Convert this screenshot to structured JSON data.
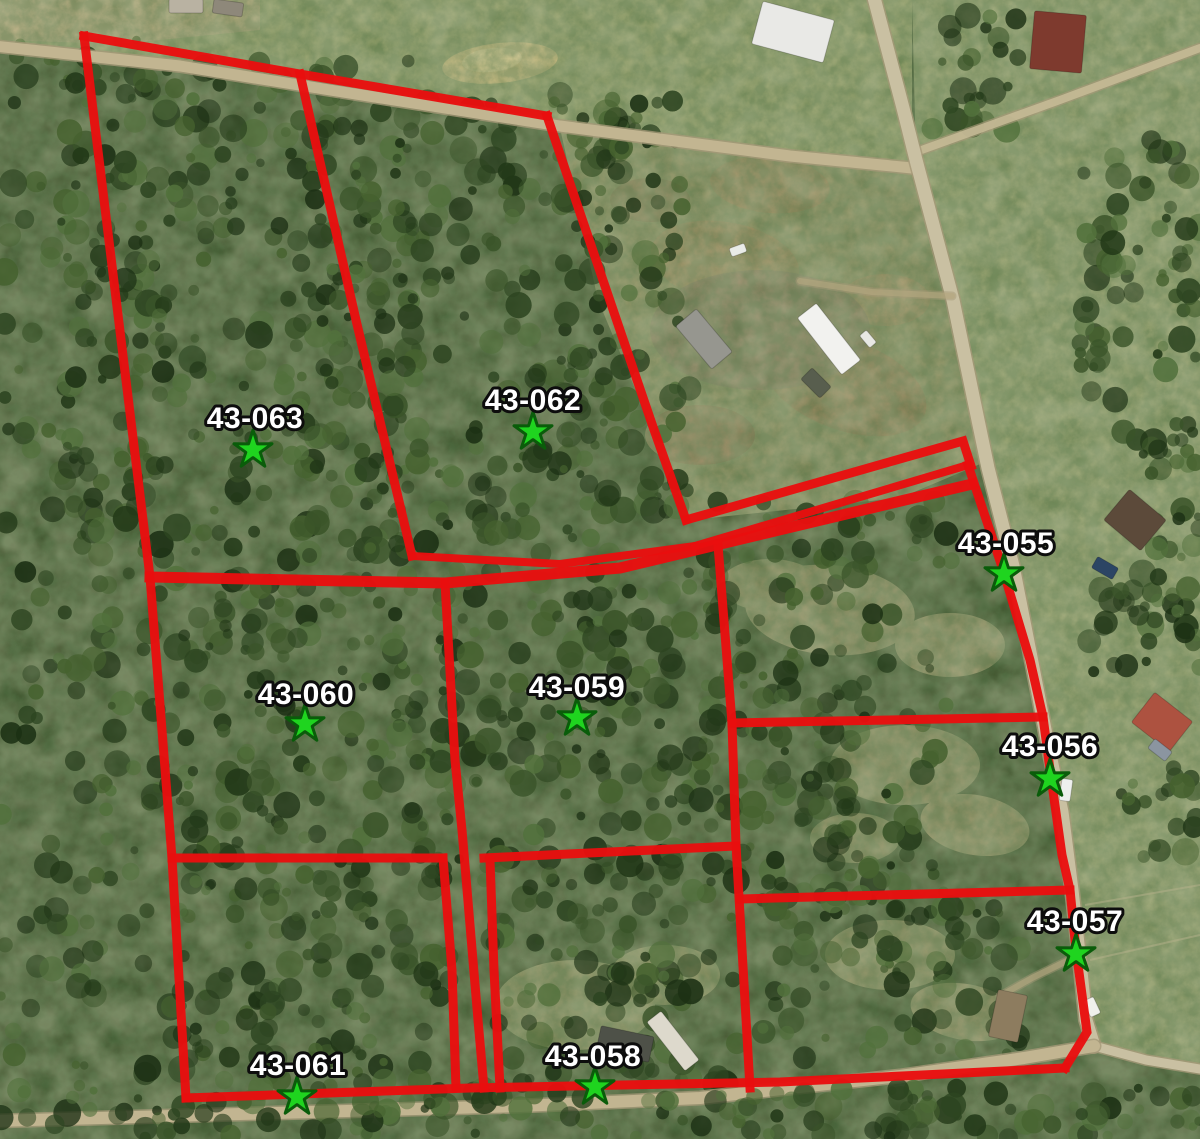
{
  "map": {
    "width": 1200,
    "height": 1139,
    "colors": {
      "boundary": "#e90f0f",
      "star_fill": "#1fd41f",
      "star_stroke": "#0a5c0a",
      "label_fill": "#ffffff",
      "label_stroke": "#0d0d0d",
      "forest_base": "#42552f",
      "field": "#97a16c",
      "road": "#c9c0a2",
      "dirt_road": "#c2b591"
    },
    "markers": [
      {
        "id": "43-063",
        "label_x": 255,
        "label_y": 428,
        "star_x": 253,
        "star_y": 450
      },
      {
        "id": "43-062",
        "label_x": 533,
        "label_y": 410,
        "star_x": 533,
        "star_y": 432
      },
      {
        "id": "43-055",
        "label_x": 1006,
        "label_y": 553,
        "star_x": 1004,
        "star_y": 574
      },
      {
        "id": "43-060",
        "label_x": 306,
        "label_y": 704,
        "star_x": 305,
        "star_y": 724
      },
      {
        "id": "43-059",
        "label_x": 577,
        "label_y": 697,
        "star_x": 577,
        "star_y": 718
      },
      {
        "id": "43-056",
        "label_x": 1050,
        "label_y": 756,
        "star_x": 1050,
        "star_y": 779
      },
      {
        "id": "43-057",
        "label_x": 1075,
        "label_y": 931,
        "star_x": 1076,
        "star_y": 954
      },
      {
        "id": "43-061",
        "label_x": 298,
        "label_y": 1075,
        "star_x": 297,
        "star_y": 1097
      },
      {
        "id": "43-058",
        "label_x": 593,
        "label_y": 1066,
        "star_x": 595,
        "star_y": 1087
      }
    ],
    "boundary_lines": [
      {
        "points": [
          [
            84,
            36
          ],
          [
            150,
            577
          ],
          [
            172,
            858
          ],
          [
            186,
            1098
          ]
        ],
        "w": 9
      },
      {
        "points": [
          [
            84,
            36
          ],
          [
            300,
            74
          ],
          [
            547,
            116
          ]
        ],
        "w": 9
      },
      {
        "points": [
          [
            300,
            74
          ],
          [
            356,
            320
          ],
          [
            412,
            556
          ]
        ],
        "w": 9
      },
      {
        "points": [
          [
            547,
            116
          ],
          [
            652,
            424
          ],
          [
            686,
            520
          ]
        ],
        "w": 9
      },
      {
        "points": [
          [
            412,
            556
          ],
          [
            560,
            564
          ],
          [
            695,
            546
          ]
        ],
        "w": 8
      },
      {
        "points": [
          [
            686,
            520
          ],
          [
            963,
            441
          ],
          [
            971,
            466
          ]
        ],
        "w": 9
      },
      {
        "points": [
          [
            695,
            546
          ],
          [
            968,
            465
          ]
        ],
        "w": 8
      },
      {
        "points": [
          [
            150,
            577
          ],
          [
            445,
            583
          ],
          [
            620,
            568
          ],
          [
            972,
            484
          ]
        ],
        "w": 11
      },
      {
        "points": [
          [
            968,
            465
          ],
          [
            1003,
            570
          ],
          [
            1030,
            660
          ],
          [
            1043,
            717
          ],
          [
            1051,
            777
          ],
          [
            1062,
            855
          ],
          [
            1070,
            890
          ],
          [
            1076,
            950
          ],
          [
            1087,
            1032
          ],
          [
            1065,
            1068
          ]
        ],
        "w": 9
      },
      {
        "points": [
          [
            1065,
            1068
          ],
          [
            780,
            1082
          ],
          [
            470,
            1088
          ],
          [
            186,
            1098
          ]
        ],
        "w": 9
      },
      {
        "points": [
          [
            445,
            583
          ],
          [
            455,
            760
          ],
          [
            462,
            830
          ],
          [
            478,
            1020
          ],
          [
            484,
            1088
          ]
        ],
        "w": 9
      },
      {
        "points": [
          [
            443,
            858
          ],
          [
            452,
            970
          ],
          [
            456,
            1088
          ]
        ],
        "w": 9
      },
      {
        "points": [
          [
            490,
            860
          ],
          [
            494,
            970
          ],
          [
            500,
            1088
          ]
        ],
        "w": 9
      },
      {
        "points": [
          [
            172,
            858
          ],
          [
            443,
            858
          ]
        ],
        "w": 9
      },
      {
        "points": [
          [
            484,
            858
          ],
          [
            736,
            846
          ]
        ],
        "w": 9
      },
      {
        "points": [
          [
            718,
            545
          ],
          [
            732,
            723
          ],
          [
            736,
            845
          ],
          [
            750,
            1088
          ]
        ],
        "w": 9
      },
      {
        "points": [
          [
            732,
            723
          ],
          [
            1043,
            717
          ]
        ],
        "w": 9
      },
      {
        "points": [
          [
            740,
            899
          ],
          [
            1070,
            890
          ]
        ],
        "w": 9
      }
    ]
  }
}
